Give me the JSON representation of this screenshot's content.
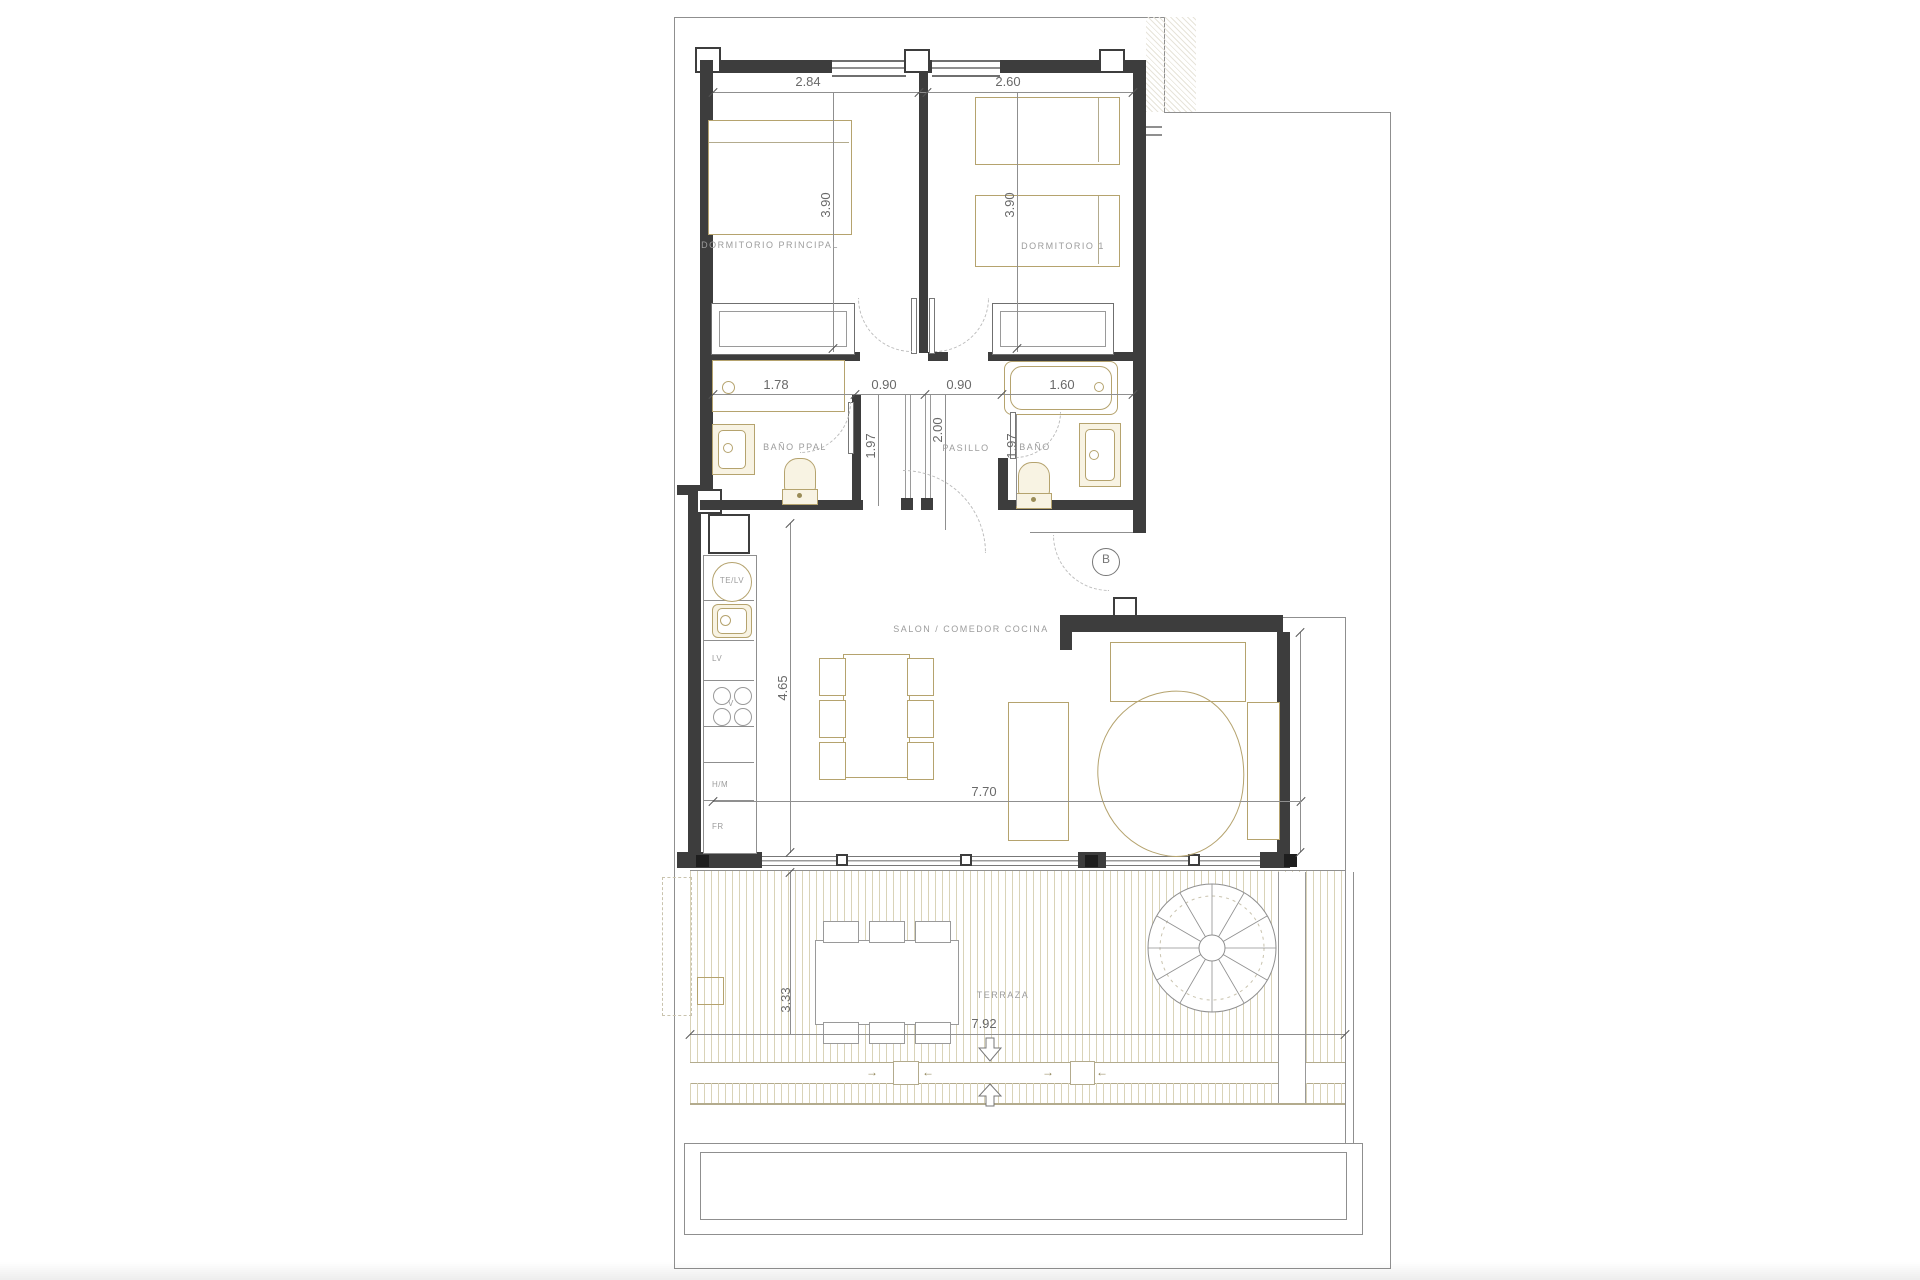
{
  "plan_type": "apartment-floor-plan",
  "rooms": {
    "dormitorio_principal": {
      "label": "DORMITORIO PRINCIPAL",
      "width": "2.84",
      "depth": "3.90"
    },
    "dormitorio_1": {
      "label": "DORMITORIO 1",
      "width": "2.60",
      "depth": "3.90"
    },
    "bano_ppal": {
      "label": "BAÑO PPAL",
      "width": "1.78",
      "depth": "1.97"
    },
    "pasillo": {
      "label": "PASILLO",
      "width_left": "0.90",
      "width_right": "0.90",
      "depth": "2.00"
    },
    "bano": {
      "label": "BAÑO",
      "bathtub_width": "1.60",
      "depth": "1.97"
    },
    "salon": {
      "label": "SALON / COMEDOR COCINA",
      "width": "7.70",
      "depth": "4.65"
    },
    "terraza": {
      "label": "TERRAZA",
      "width": "7.92",
      "depth": "3.33",
      "arrow_right": "→",
      "arrow_left": "←"
    }
  },
  "kitchen": {
    "te_lv": "TE/LV",
    "lv": "LV",
    "v": "V",
    "hm": "H/M",
    "fr": "FR"
  },
  "markers": {
    "section_b": "B"
  },
  "colors": {
    "wall": "#3d3d3d",
    "thin_line": "#8f8f8f",
    "furniture_tan": "#b5a36e",
    "fixture_fill": "#f8f3e3",
    "deck_stripe": "#d9d3b8",
    "room_label": "#9c9c9c",
    "dim_text": "#696969"
  }
}
